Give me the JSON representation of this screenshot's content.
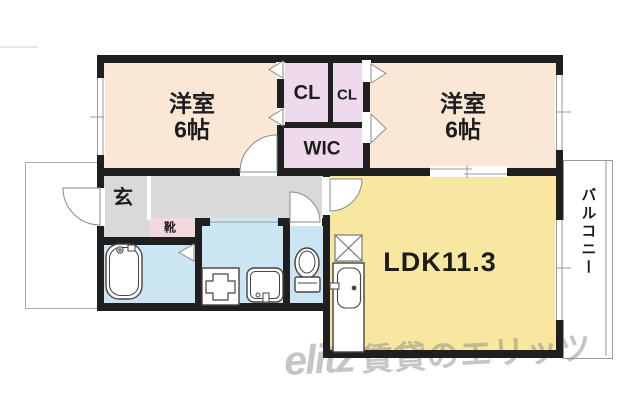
{
  "rooms": {
    "bedroom_left": {
      "name_jp": "洋室",
      "size_jp": "6帖"
    },
    "bedroom_right": {
      "name_jp": "洋室",
      "size_jp": "6帖"
    },
    "closet_left": {
      "label": "CL"
    },
    "closet_right": {
      "label": "CL"
    },
    "wic": {
      "label": "WIC"
    },
    "ldk": {
      "label": "LDK11.3"
    },
    "entrance": {
      "label": "玄"
    },
    "shoe_cabinet": {
      "label": "靴"
    },
    "balcony": {
      "label": "バルコニー"
    }
  },
  "watermark": {
    "logo": "elitz",
    "text": "賃貸のエリッツ"
  },
  "colors": {
    "wall": "#1f1f1f",
    "bedroom": "#fae7d6",
    "closet": "#eedaec",
    "ldk": "#f7e7a1",
    "hall": "#d9d9d9",
    "shoe": "#f3d8de",
    "water": "#cbe5f3"
  }
}
